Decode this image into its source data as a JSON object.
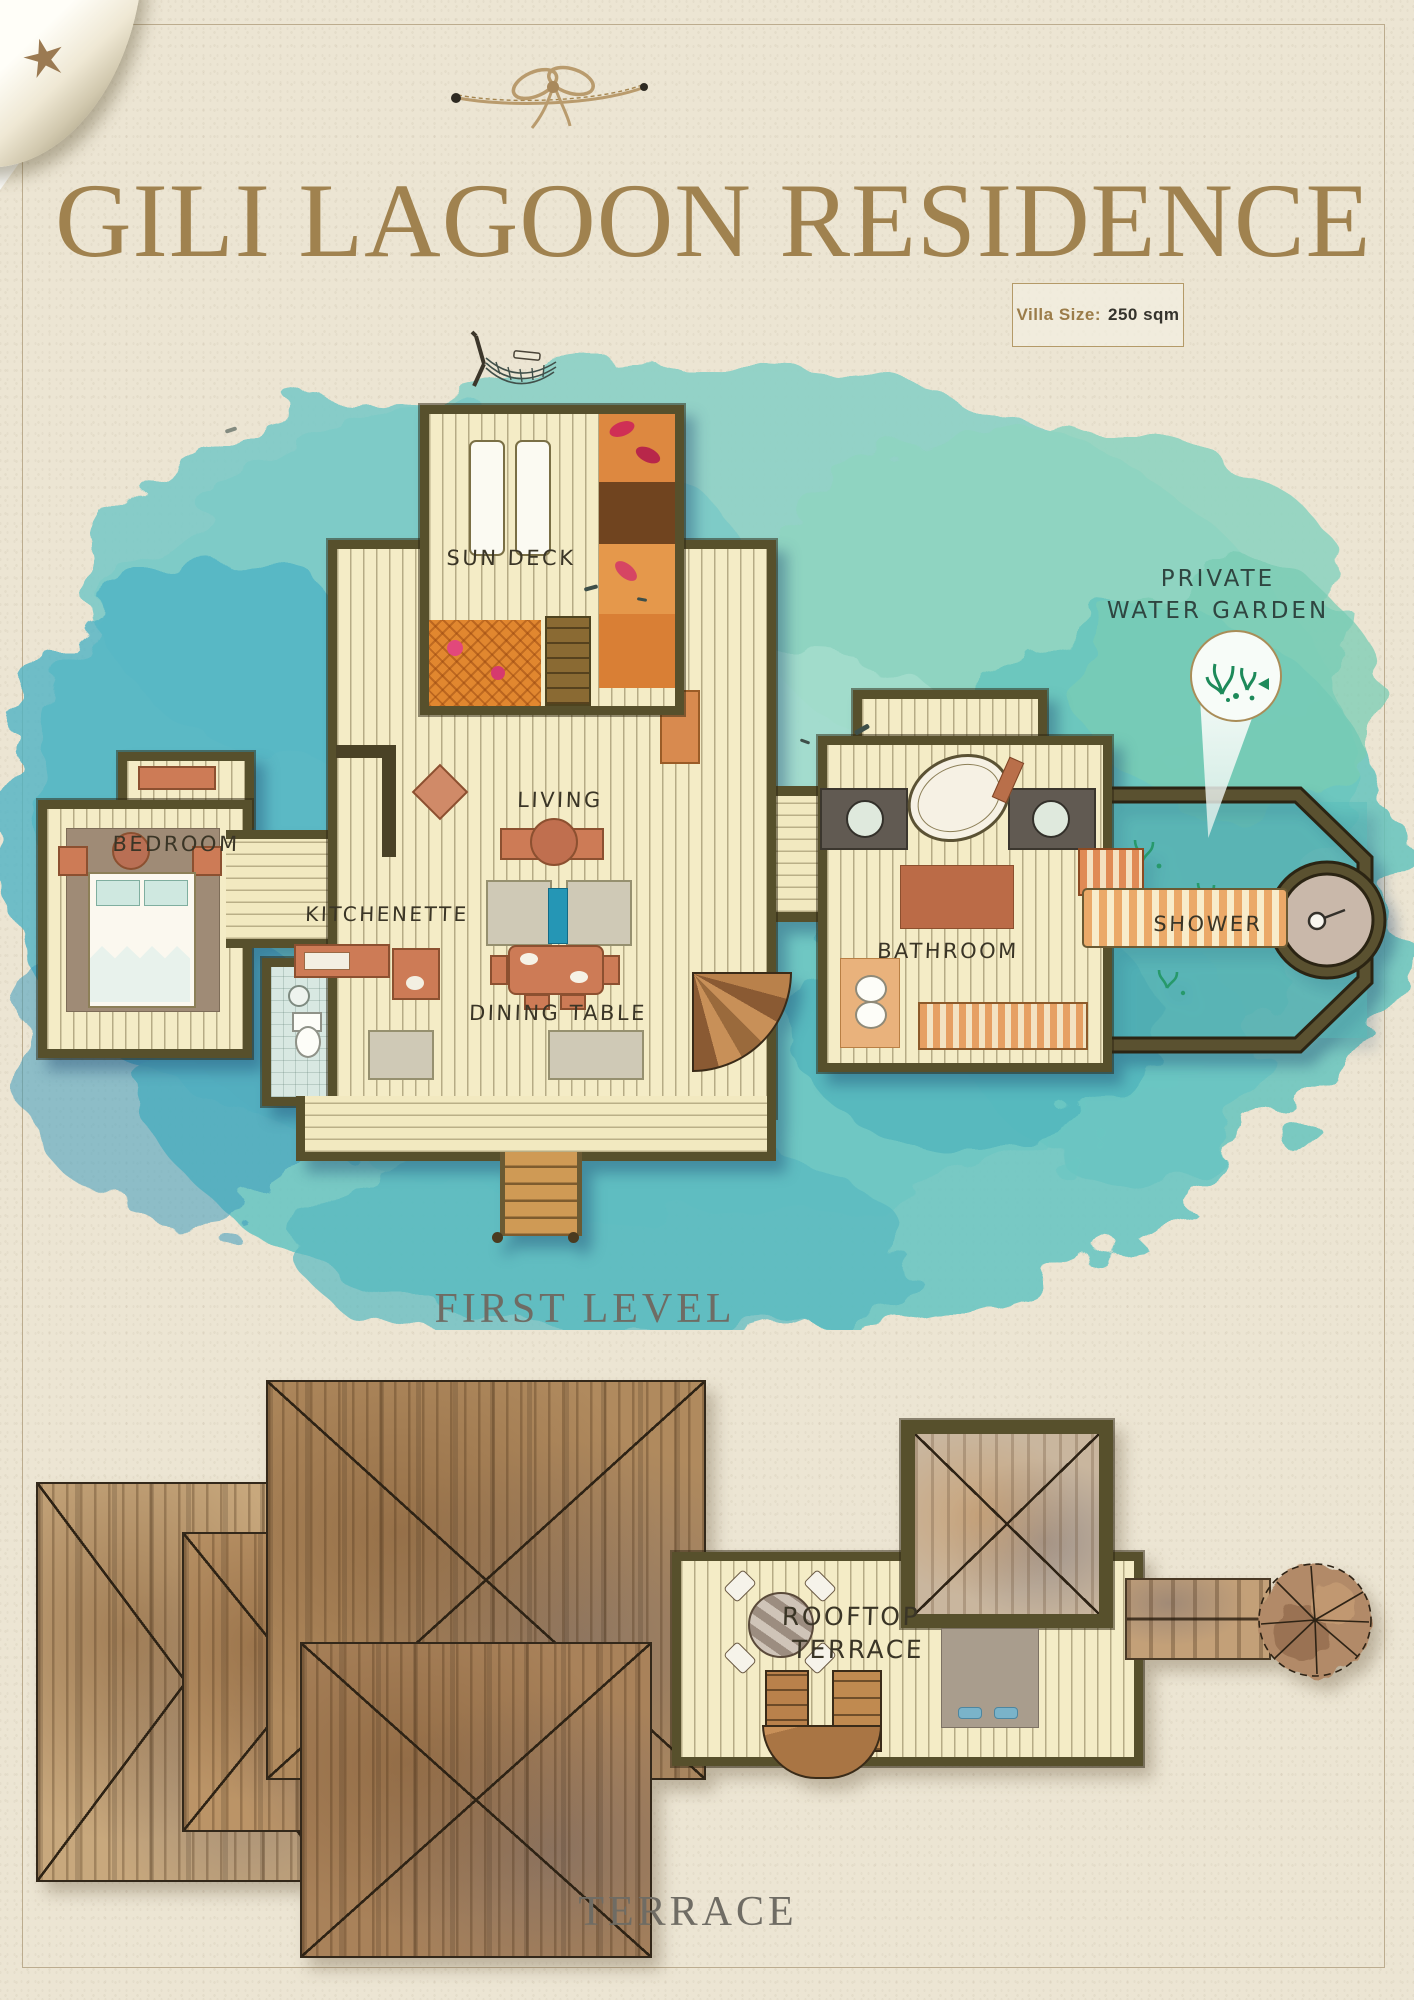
{
  "header": {
    "title": "GILI LAGOON RESIDENCE",
    "villa_size_label": "Villa Size:",
    "villa_size_value": "250 sqm"
  },
  "first_level": {
    "caption": "FIRST LEVEL",
    "rooms": {
      "sun_deck": "SUN DECK",
      "bedroom": "BEDROOM",
      "kitchenette": "KITCHENETTE",
      "living": "LIVING",
      "dining_table": "DINING TABLE",
      "bathroom": "BATHROOM",
      "shower": "SHOWER"
    },
    "callout": {
      "line1": "PRIVATE",
      "line2": "WATER GARDEN"
    }
  },
  "terrace_level": {
    "caption": "TERRACE",
    "rooftop_line1": "ROOFTOP",
    "rooftop_line2": "TERRACE"
  },
  "colors": {
    "paper": "#ece5d3",
    "title_gold": "#a0824f",
    "water_teal": "#6cc5c2",
    "wall_olive": "#57502c",
    "plank_cream": "#f4ecc6",
    "terracotta": "#cd7b56",
    "deck_orange": "#e1872f",
    "roof_tan": "#b08a5e",
    "label_ink": "#3a3526",
    "caption_gray": "#6f6c64"
  }
}
